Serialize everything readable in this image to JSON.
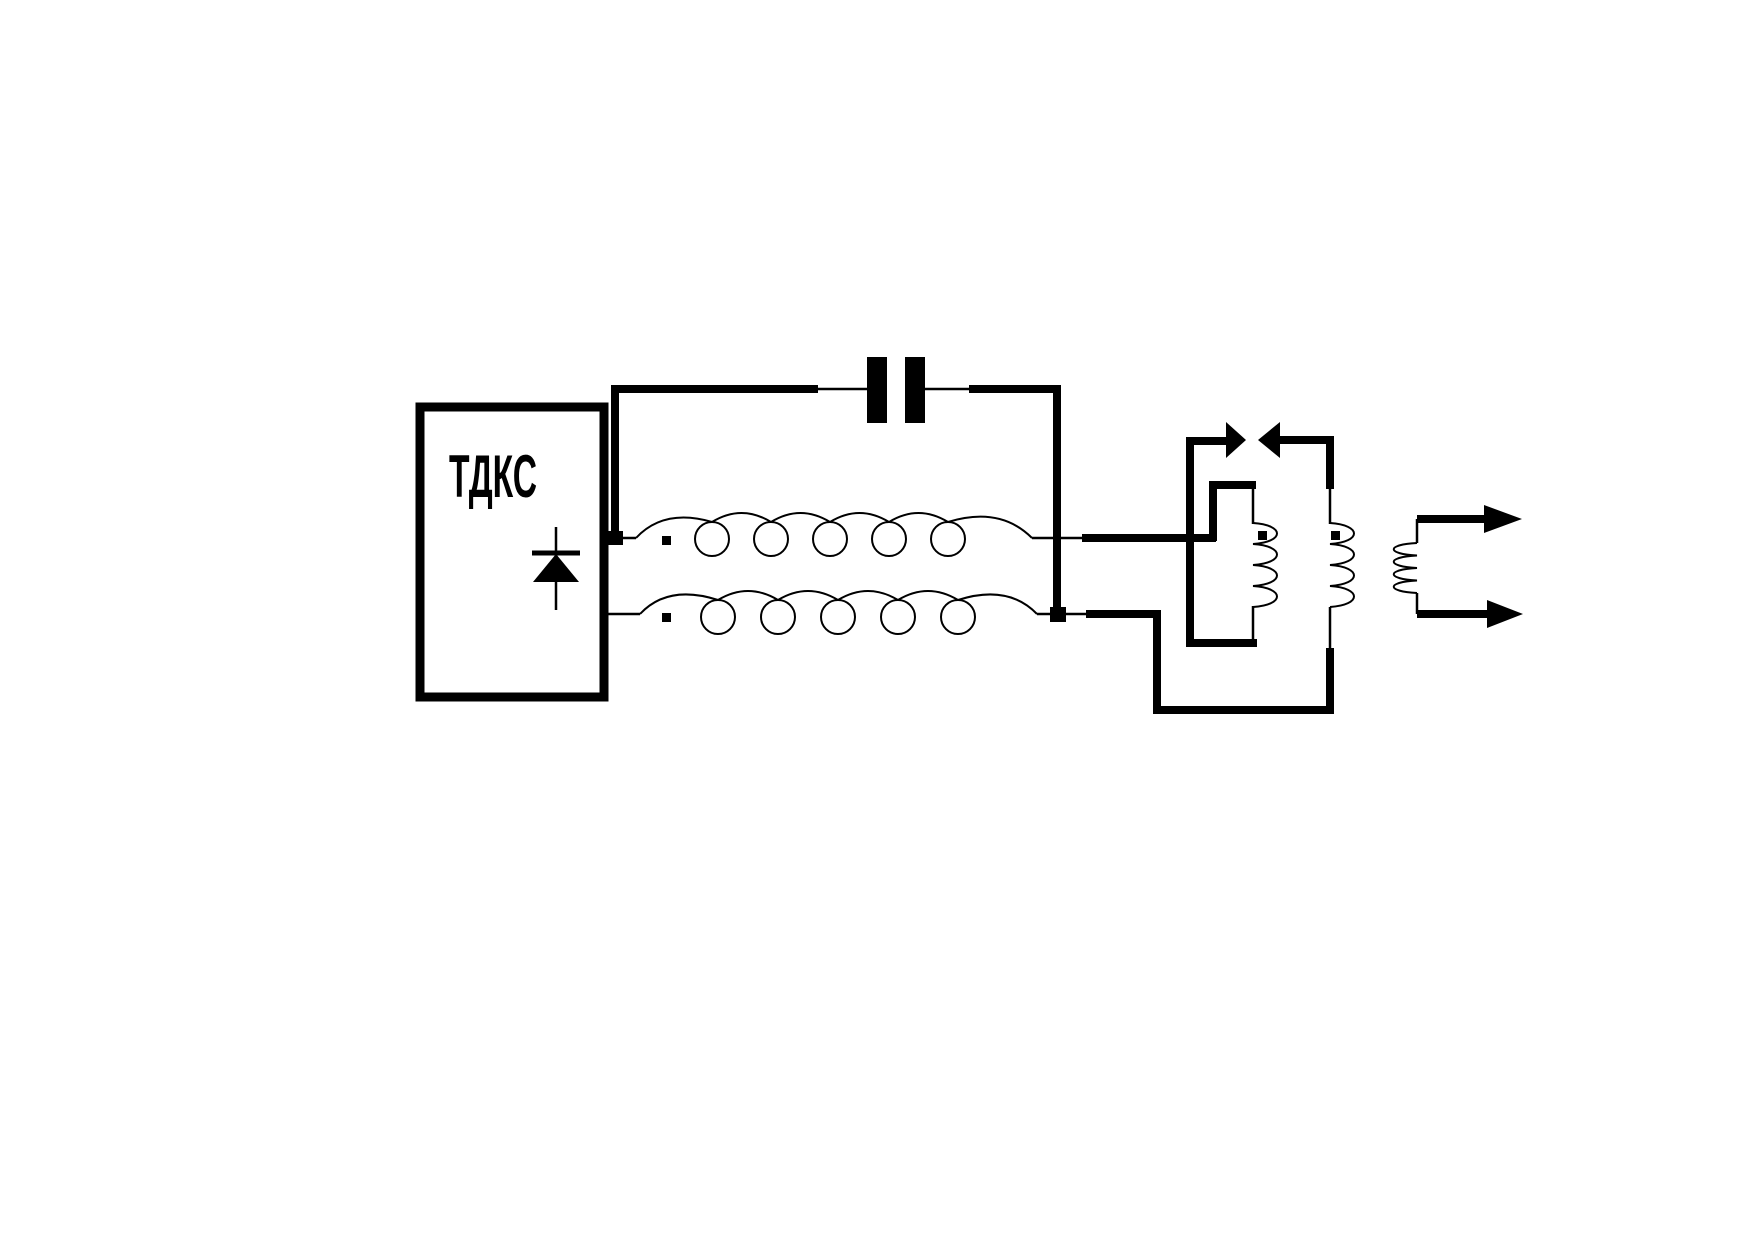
{
  "colors": {
    "ink": "#000000",
    "background": "#ffffff"
  },
  "flyback": {
    "label": "ТДКС"
  },
  "schematic": {
    "kind": "flyback-transformer-output-circuit",
    "capacitor_plates": 2,
    "coupling_winding_top_loops": 5,
    "coupling_winding_bottom_loops": 5,
    "primary_winding_arcs": 4,
    "secondary_winding_arcs": 4,
    "output_winding_arcs": 4,
    "polarity_dots": 4,
    "facing_diodes": 2,
    "output_arrows": 2
  }
}
